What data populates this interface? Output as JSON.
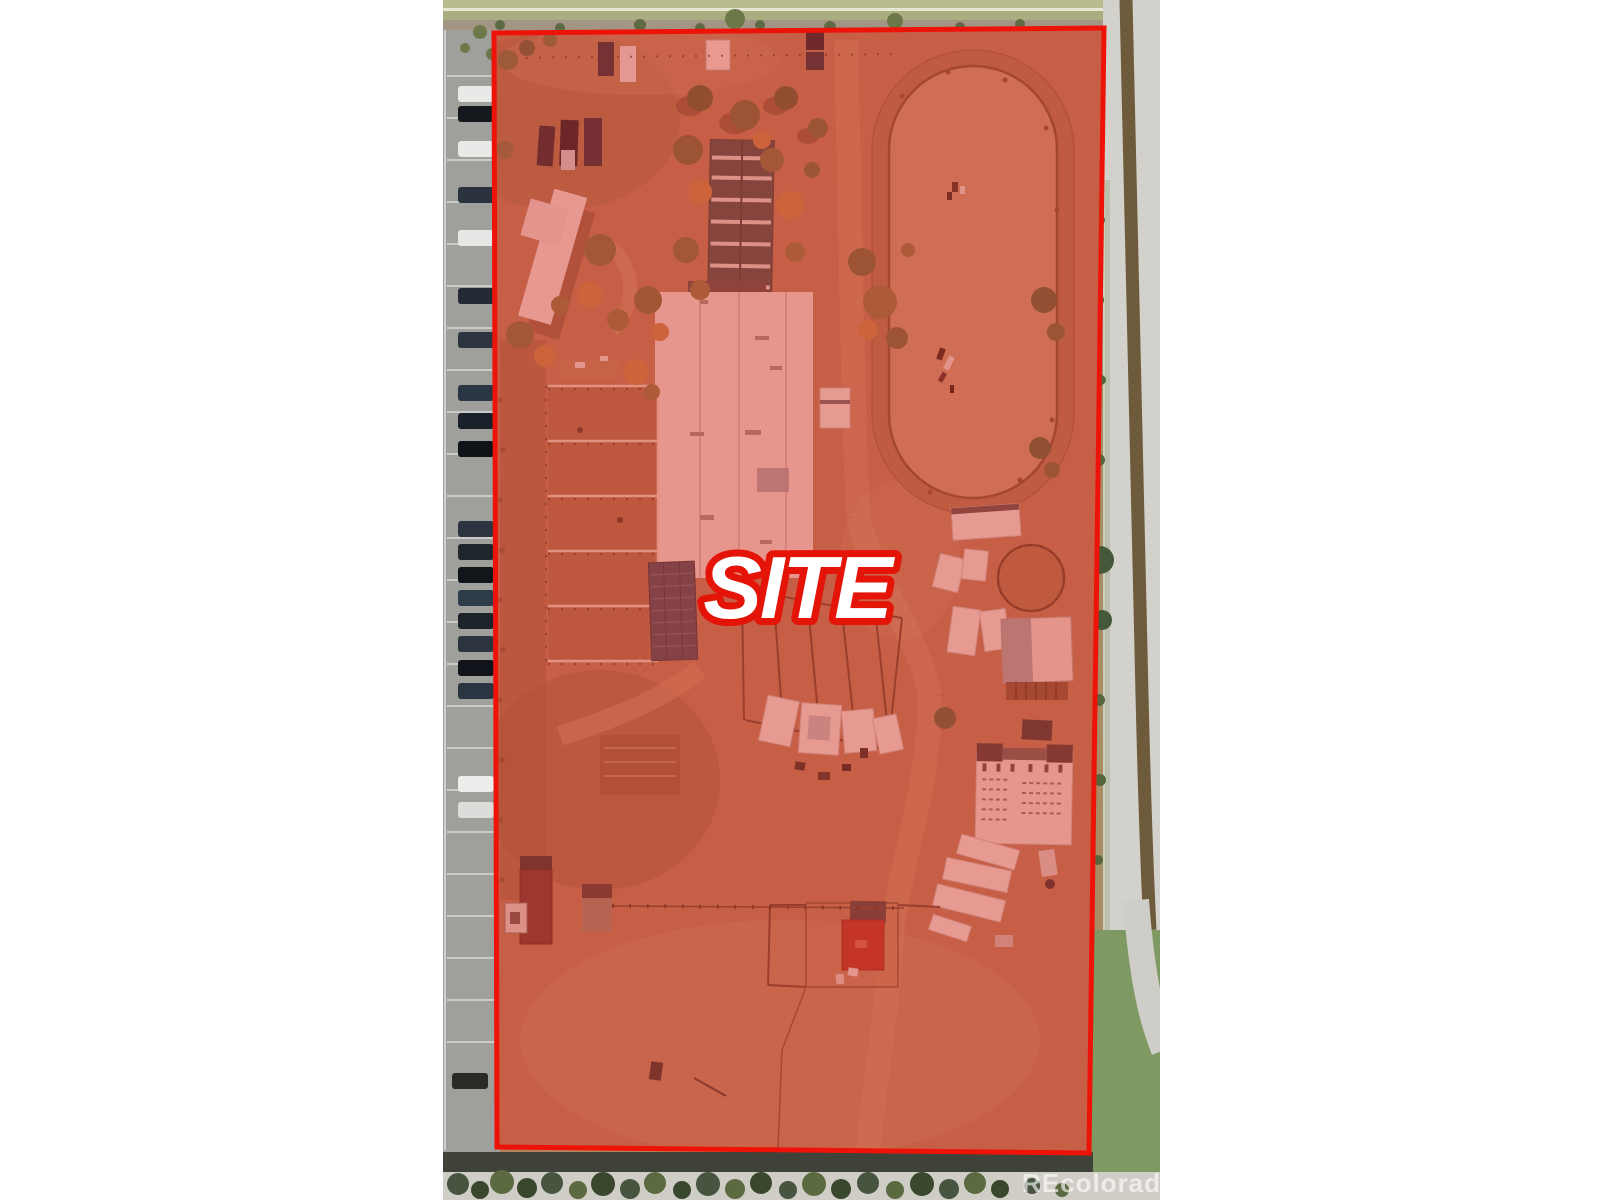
{
  "page": {
    "background_color": "#ffffff"
  },
  "photo": {
    "type": "aerial-photo",
    "description": "Overhead aerial view of an equestrian property marked as the subject site",
    "landmarks": {
      "west": "parking lot with parked cars",
      "north": "road frontage with tree and fence line",
      "east": "concrete drainage channel with grass strip",
      "south": "road with street tree line",
      "on_site": [
        "riding arena oval",
        "large white barn",
        "green-roofed barn",
        "farmhouse",
        "horse paddock rows",
        "round pen",
        "stable building",
        "horse trailers",
        "red-roofed outbuilding",
        "sheds"
      ]
    }
  },
  "overlay": {
    "site_label": "SITE",
    "boundary_stroke_color": "#ed1309",
    "boundary_fill_color": "rgba(222,45,38,0.42)",
    "label_fill_color": "#ffffff",
    "label_outline_color": "#e41408"
  },
  "watermark": {
    "text": "REcolorado",
    "color": "rgba(255,255,255,0.62)"
  }
}
